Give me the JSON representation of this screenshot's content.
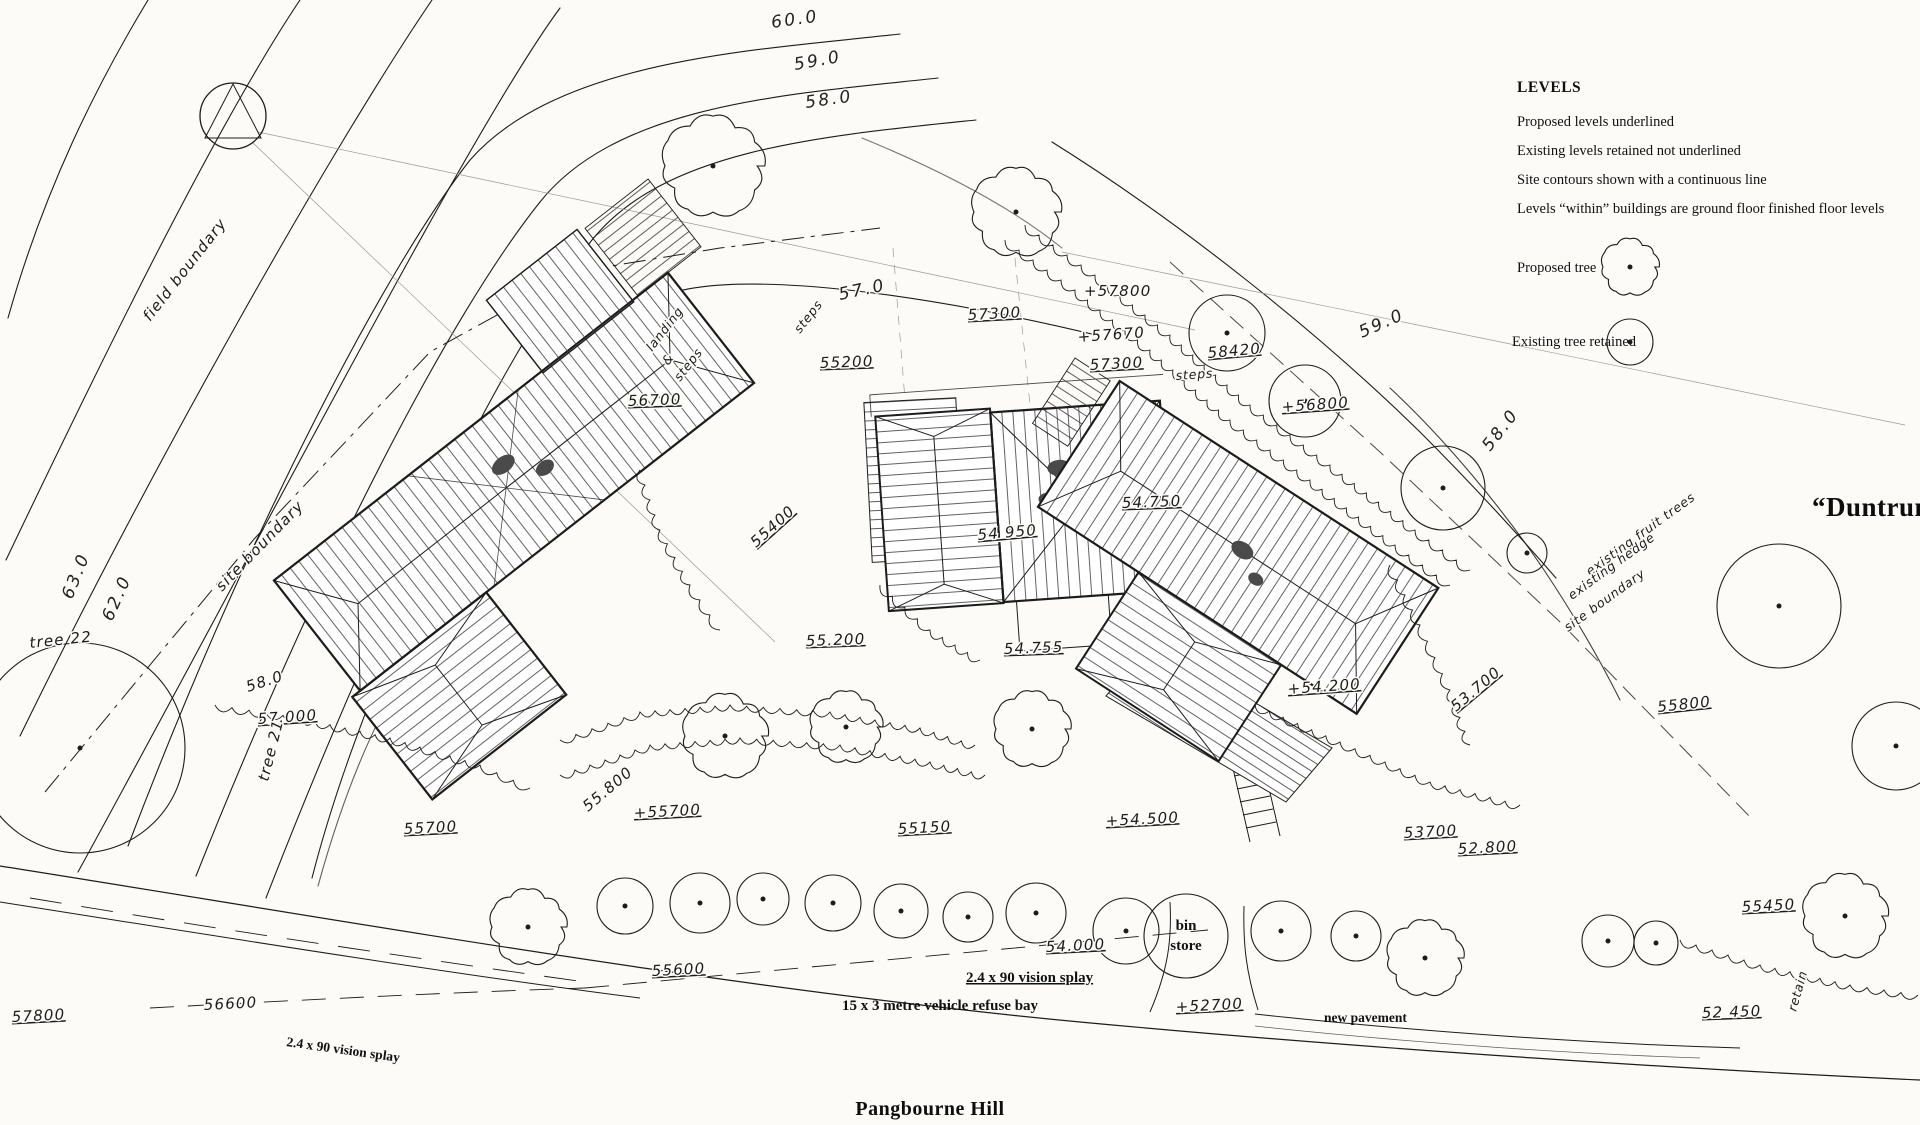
{
  "sheet": {
    "site_name": "“Duntrune”",
    "road_name": "Pangbourne Hill"
  },
  "legend": {
    "heading": "LEVELS",
    "lines": [
      "Proposed levels underlined",
      "Existing levels retained not underlined",
      "Site contours shown with a continuous line",
      "Levels “within” buildings are ground floor finished floor levels"
    ],
    "proposed_tree": "Proposed tree",
    "existing_tree": "Existing tree retained"
  },
  "colors": {
    "ink": "#1c1c1c",
    "paper": "#fcfbf8",
    "faint": "#999999"
  },
  "annotations": [
    {
      "t": "60.0",
      "x": 772,
      "y": 28,
      "r": -8,
      "s": "hl"
    },
    {
      "t": "59.0",
      "x": 795,
      "y": 70,
      "r": -10,
      "s": "hl"
    },
    {
      "t": "58.0",
      "x": 806,
      "y": 108,
      "r": -8,
      "s": "hl"
    },
    {
      "t": "57.0",
      "x": 840,
      "y": 300,
      "r": -12,
      "s": "hl"
    },
    {
      "t": "59.0",
      "x": 1362,
      "y": 338,
      "r": -24,
      "s": "hl"
    },
    {
      "t": "58.0",
      "x": 1490,
      "y": 452,
      "r": -52,
      "s": "hl"
    },
    {
      "t": "63.0",
      "x": 72,
      "y": 600,
      "r": -68,
      "s": "hl"
    },
    {
      "t": "62.0",
      "x": 112,
      "y": 622,
      "r": -66,
      "s": "hl"
    },
    {
      "t": "58.0",
      "x": 248,
      "y": 692,
      "r": -18,
      "s": "h"
    },
    {
      "t": "57.000",
      "x": 258,
      "y": 724,
      "r": -4,
      "s": "h",
      "u": true
    },
    {
      "t": "field boundary",
      "x": 150,
      "y": 322,
      "r": -52,
      "s": "h"
    },
    {
      "t": "site boundary",
      "x": 222,
      "y": 592,
      "r": -46,
      "s": "h"
    },
    {
      "t": "tree 22",
      "x": 30,
      "y": 648,
      "r": -6,
      "s": "h"
    },
    {
      "t": "tree 21",
      "x": 268,
      "y": 782,
      "r": -76,
      "s": "h"
    },
    {
      "t": "existing fruit trees",
      "x": 1590,
      "y": 576,
      "r": -36,
      "s": "hs"
    },
    {
      "t": "existing hedge",
      "x": 1572,
      "y": 600,
      "r": -36,
      "s": "hs"
    },
    {
      "t": "site boundary",
      "x": 1568,
      "y": 632,
      "r": -36,
      "s": "hs"
    },
    {
      "t": "55200",
      "x": 820,
      "y": 368,
      "r": -2,
      "s": "h",
      "u": true
    },
    {
      "t": "56700",
      "x": 628,
      "y": 406,
      "r": -2,
      "s": "h",
      "u": true
    },
    {
      "t": "landing",
      "x": 652,
      "y": 352,
      "r": -52,
      "s": "hs"
    },
    {
      "t": "&",
      "x": 668,
      "y": 366,
      "r": -52,
      "s": "hs"
    },
    {
      "t": "steps",
      "x": 680,
      "y": 382,
      "r": -52,
      "s": "hs"
    },
    {
      "t": "steps",
      "x": 800,
      "y": 334,
      "r": -52,
      "s": "hs"
    },
    {
      "t": "57300",
      "x": 968,
      "y": 320,
      "r": -3,
      "s": "h",
      "u": true
    },
    {
      "t": "+57800",
      "x": 1084,
      "y": 296,
      "r": 0,
      "s": "h"
    },
    {
      "t": "+57670",
      "x": 1078,
      "y": 342,
      "r": -4,
      "s": "h"
    },
    {
      "t": "57300",
      "x": 1090,
      "y": 370,
      "r": -3,
      "s": "h",
      "u": true
    },
    {
      "t": "58420",
      "x": 1208,
      "y": 358,
      "r": -5,
      "s": "h",
      "u": true
    },
    {
      "t": "steps",
      "x": 1176,
      "y": 380,
      "r": -4,
      "s": "hs"
    },
    {
      "t": "+56800",
      "x": 1282,
      "y": 412,
      "r": -4,
      "s": "h",
      "u": true
    },
    {
      "t": "54.750",
      "x": 1122,
      "y": 508,
      "r": -2,
      "s": "h",
      "u": true
    },
    {
      "t": "54 950",
      "x": 978,
      "y": 540,
      "r": -5,
      "s": "h",
      "u": true
    },
    {
      "t": "55400",
      "x": 756,
      "y": 548,
      "r": -42,
      "s": "h",
      "u": true
    },
    {
      "t": "55.200",
      "x": 806,
      "y": 646,
      "r": -2,
      "s": "h",
      "u": true
    },
    {
      "t": "54.755",
      "x": 1004,
      "y": 654,
      "r": -2,
      "s": "h",
      "u": true
    },
    {
      "t": "+54.200",
      "x": 1288,
      "y": 694,
      "r": -4,
      "s": "h",
      "u": true
    },
    {
      "t": "53.700",
      "x": 1456,
      "y": 712,
      "r": -40,
      "s": "h",
      "u": true
    },
    {
      "t": "55800",
      "x": 1658,
      "y": 712,
      "r": -6,
      "s": "h",
      "u": true
    },
    {
      "t": "55.800",
      "x": 588,
      "y": 812,
      "r": -40,
      "s": "h"
    },
    {
      "t": "55700",
      "x": 404,
      "y": 834,
      "r": -3,
      "s": "h",
      "u": true
    },
    {
      "t": "+55700",
      "x": 634,
      "y": 818,
      "r": -3,
      "s": "h",
      "u": true
    },
    {
      "t": "55150",
      "x": 898,
      "y": 834,
      "r": -3,
      "s": "h",
      "u": true
    },
    {
      "t": "+54.500",
      "x": 1106,
      "y": 826,
      "r": -3,
      "s": "h",
      "u": true
    },
    {
      "t": "53700",
      "x": 1404,
      "y": 838,
      "r": -3,
      "s": "h",
      "u": true
    },
    {
      "t": "52.800",
      "x": 1458,
      "y": 854,
      "r": -3,
      "s": "h",
      "u": true
    },
    {
      "t": "55600",
      "x": 652,
      "y": 976,
      "r": -3,
      "s": "h",
      "u": true
    },
    {
      "t": "54.000",
      "x": 1046,
      "y": 952,
      "r": -3,
      "s": "h",
      "u": true
    },
    {
      "t": "+52700",
      "x": 1176,
      "y": 1012,
      "r": -3,
      "s": "h",
      "u": true
    },
    {
      "t": "52 450",
      "x": 1702,
      "y": 1018,
      "r": -2,
      "s": "h",
      "u": true
    },
    {
      "t": "retain",
      "x": 1796,
      "y": 1012,
      "r": -74,
      "s": "hs"
    },
    {
      "t": "55450",
      "x": 1742,
      "y": 912,
      "r": -3,
      "s": "h",
      "u": true
    },
    {
      "t": "56600",
      "x": 204,
      "y": 1010,
      "r": -3,
      "s": "h"
    },
    {
      "t": "57800",
      "x": 12,
      "y": 1022,
      "r": -3,
      "s": "h",
      "u": true
    },
    {
      "t": "bin",
      "x": 1186,
      "y": 930,
      "s": "tb",
      "a": "middle"
    },
    {
      "t": "store",
      "x": 1186,
      "y": 950,
      "s": "tb",
      "a": "middle"
    },
    {
      "t": "2.4 x 90 vision splay",
      "x": 966,
      "y": 982,
      "s": "tb",
      "u": true
    },
    {
      "t": "15 x 3 metre vehicle refuse bay",
      "x": 842,
      "y": 1010,
      "s": "tb"
    },
    {
      "t": "new pavement",
      "x": 1324,
      "y": 1022,
      "s": "tbs"
    },
    {
      "t": "2.4 x 90 vision splay",
      "x": 286,
      "y": 1046,
      "r": 8,
      "s": "tbs"
    },
    {
      "t": "“Duntrune”",
      "x": 1812,
      "y": 516,
      "s": "nb"
    },
    {
      "t": "Pangbourne Hill",
      "x": 930,
      "y": 1115,
      "s": "nm",
      "a": "middle"
    }
  ],
  "trees": [
    {
      "x": 233,
      "y": 116,
      "r": 33,
      "k": "n"
    },
    {
      "x": 713,
      "y": 166,
      "r": 48,
      "k": "s"
    },
    {
      "x": 1016,
      "y": 212,
      "r": 42,
      "k": "s"
    },
    {
      "x": 1227,
      "y": 333,
      "r": 38,
      "k": "p"
    },
    {
      "x": 1305,
      "y": 401,
      "r": 36,
      "k": "p"
    },
    {
      "x": 1443,
      "y": 488,
      "r": 42,
      "k": "p"
    },
    {
      "x": 1527,
      "y": 553,
      "r": 20,
      "k": "p"
    },
    {
      "x": 1779,
      "y": 606,
      "r": 62,
      "k": "p"
    },
    {
      "x": 1896,
      "y": 746,
      "r": 44,
      "k": "p"
    },
    {
      "x": 80,
      "y": 748,
      "r": 105,
      "k": "p"
    },
    {
      "x": 725,
      "y": 736,
      "r": 40,
      "k": "s"
    },
    {
      "x": 846,
      "y": 727,
      "r": 34,
      "k": "s"
    },
    {
      "x": 1032,
      "y": 729,
      "r": 36,
      "k": "s"
    },
    {
      "x": 528,
      "y": 927,
      "r": 36,
      "k": "s"
    },
    {
      "x": 625,
      "y": 906,
      "r": 28,
      "k": "p"
    },
    {
      "x": 700,
      "y": 903,
      "r": 30,
      "k": "p"
    },
    {
      "x": 763,
      "y": 899,
      "r": 26,
      "k": "p"
    },
    {
      "x": 833,
      "y": 903,
      "r": 28,
      "k": "p"
    },
    {
      "x": 901,
      "y": 911,
      "r": 27,
      "k": "p"
    },
    {
      "x": 968,
      "y": 917,
      "r": 25,
      "k": "p"
    },
    {
      "x": 1036,
      "y": 913,
      "r": 30,
      "k": "p"
    },
    {
      "x": 1126,
      "y": 931,
      "r": 33,
      "k": "p"
    },
    {
      "x": 1186,
      "y": 936,
      "r": 42,
      "k": "b"
    },
    {
      "x": 1281,
      "y": 931,
      "r": 30,
      "k": "p"
    },
    {
      "x": 1356,
      "y": 936,
      "r": 25,
      "k": "p"
    },
    {
      "x": 1425,
      "y": 958,
      "r": 36,
      "k": "s"
    },
    {
      "x": 1608,
      "y": 941,
      "r": 26,
      "k": "p"
    },
    {
      "x": 1656,
      "y": 943,
      "r": 22,
      "k": "p"
    },
    {
      "x": 1845,
      "y": 916,
      "r": 40,
      "k": "s"
    },
    {
      "x": 1630,
      "y": 267,
      "r": 27,
      "k": "s"
    },
    {
      "x": 1630,
      "y": 342,
      "r": 23,
      "k": "p"
    }
  ]
}
